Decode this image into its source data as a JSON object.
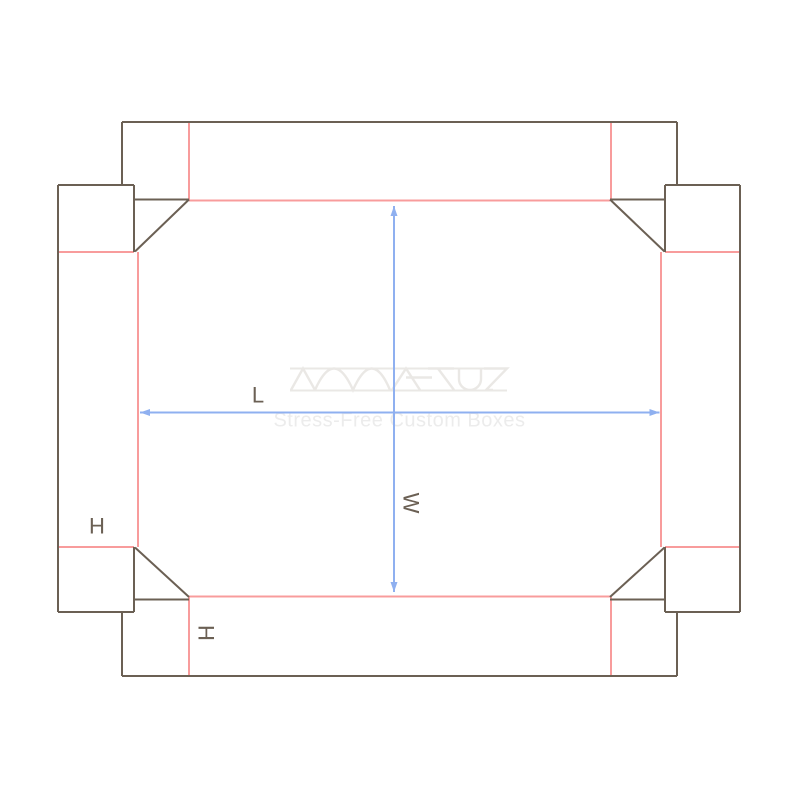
{
  "canvas": {
    "width": 800,
    "height": 800,
    "background": "#ffffff"
  },
  "colors": {
    "cut_line": "#6B6054",
    "fold_line": "#F89C9C",
    "dimension_line": "#8FB0F0",
    "label_text": "#6B6054",
    "watermark_logo": "#EAE8E5",
    "watermark_tagline": "#ECECEC"
  },
  "dieline": {
    "cut_lines": [
      [
        122,
        122,
        677,
        122
      ],
      [
        122,
        122,
        122,
        185
      ],
      [
        677,
        122,
        677,
        185
      ],
      [
        58,
        185,
        134,
        185
      ],
      [
        665,
        185,
        740,
        185
      ],
      [
        58,
        185,
        58,
        612
      ],
      [
        740,
        185,
        740,
        612
      ],
      [
        134,
        185,
        134,
        252
      ],
      [
        665,
        185,
        665,
        252
      ],
      [
        134,
        199.5,
        189,
        199.5
      ],
      [
        610,
        199.5,
        665,
        199.5
      ],
      [
        189,
        199.5,
        135,
        251.5
      ],
      [
        610,
        199.5,
        664.5,
        251.5
      ],
      [
        134,
        547,
        134,
        612
      ],
      [
        665,
        547,
        665,
        612
      ],
      [
        135,
        547.5,
        189,
        597
      ],
      [
        664.5,
        547.5,
        610,
        597
      ],
      [
        134,
        599.5,
        189,
        599.5
      ],
      [
        610,
        599.5,
        665,
        599.5
      ],
      [
        58,
        612,
        134,
        612
      ],
      [
        665,
        612,
        740,
        612
      ],
      [
        122,
        612,
        122,
        676
      ],
      [
        677,
        612,
        677,
        676
      ],
      [
        122,
        676,
        677,
        676
      ]
    ],
    "fold_lines": [
      [
        189,
        122,
        189,
        200
      ],
      [
        611,
        122,
        611,
        200
      ],
      [
        189,
        200.5,
        610,
        200.5
      ],
      [
        58,
        252,
        134,
        252
      ],
      [
        665,
        252,
        740,
        252
      ],
      [
        138,
        252,
        138,
        547
      ],
      [
        661,
        252,
        661,
        547
      ],
      [
        58,
        547,
        134,
        547
      ],
      [
        665,
        547,
        740,
        547
      ],
      [
        189,
        596.5,
        610,
        596.5
      ],
      [
        189,
        597,
        189,
        676
      ],
      [
        611,
        597,
        611,
        676
      ]
    ]
  },
  "dimensions": [
    {
      "name": "length",
      "label": "L",
      "x1": 140,
      "y1": 412.5,
      "x2": 659.5,
      "y2": 412.5
    },
    {
      "name": "width",
      "label": "W",
      "x1": 394,
      "y1": 206,
      "x2": 394,
      "y2": 592
    }
  ],
  "annotations": [
    {
      "text": "L",
      "x": 258,
      "y": 395,
      "rotation": 0
    },
    {
      "text": "W",
      "x": 411,
      "y": 503,
      "rotation": 90
    },
    {
      "text": "H",
      "x": 97,
      "y": 526,
      "rotation": 0
    },
    {
      "text": "H",
      "x": 206,
      "y": 633,
      "rotation": 90
    }
  ],
  "watermark": {
    "tagline": "Stress-Free Custom Boxes",
    "tagline_x": 399.5,
    "tagline_y": 420.5,
    "rules": [
      [
        290,
        368.5,
        507,
        368.5
      ],
      [
        290,
        390.5,
        507,
        390.5
      ]
    ],
    "logo_paths": [
      "M291,390 L303,368.5 L315,390",
      "M315,390 Q334,347 353,390 Q372,347 390,390",
      "M392,390 L406,368.5 L420,390",
      "M406,377.5 L432,377.5",
      "M428,368.5 L454,368.5",
      "M438,368.5 L454,390",
      "M459,369 L459,379 A11 11 0 0 0 481,379 L481,369",
      "M484,368.5 L507,368.5 L486,390 L493,390"
    ]
  }
}
